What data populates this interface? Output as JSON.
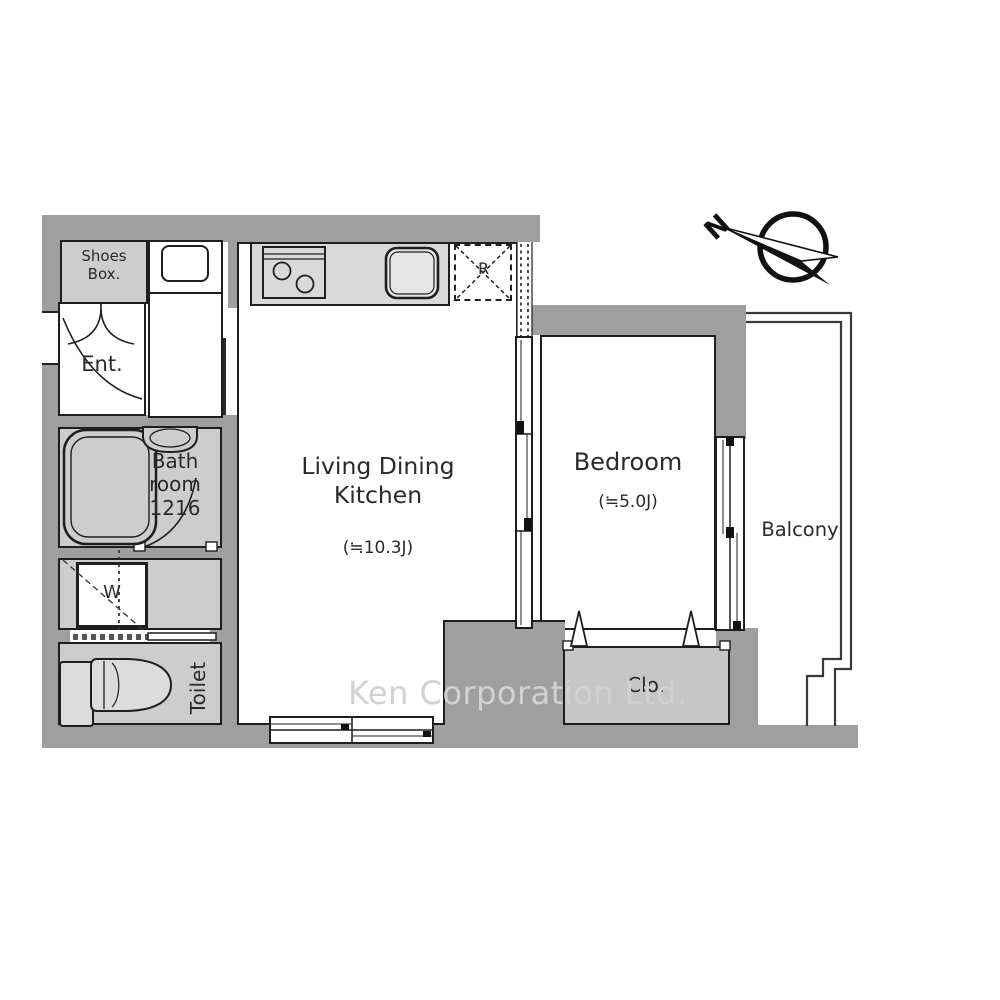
{
  "plan": {
    "watermark": "Ken Corporation Ltd.",
    "compass": {
      "north_label": "N"
    },
    "rooms": {
      "shoes_box": {
        "label": "Shoes Box."
      },
      "entrance": {
        "label": "Ent."
      },
      "bathroom": {
        "label": "Bath room 1216"
      },
      "washer": {
        "label": "W"
      },
      "toilet": {
        "label": "Toilet"
      },
      "ldk": {
        "label": "Living Dining Kitchen",
        "size": "(≒10.3J)"
      },
      "bedroom": {
        "label": "Bedroom",
        "size": "(≒5.0J)"
      },
      "closet": {
        "label": "Clo."
      },
      "balcony": {
        "label": "Balcony"
      },
      "refrigerator": {
        "label": "R"
      }
    },
    "colors": {
      "wall": "#9f9f9f",
      "wet_room_fill": "#cdcdcd",
      "counter_fill": "#d9d9d9",
      "closet_fill": "#c6c6c6",
      "linework": "#1e1e1e",
      "watermark": "#d2d2d2",
      "background": "#ffffff"
    }
  }
}
